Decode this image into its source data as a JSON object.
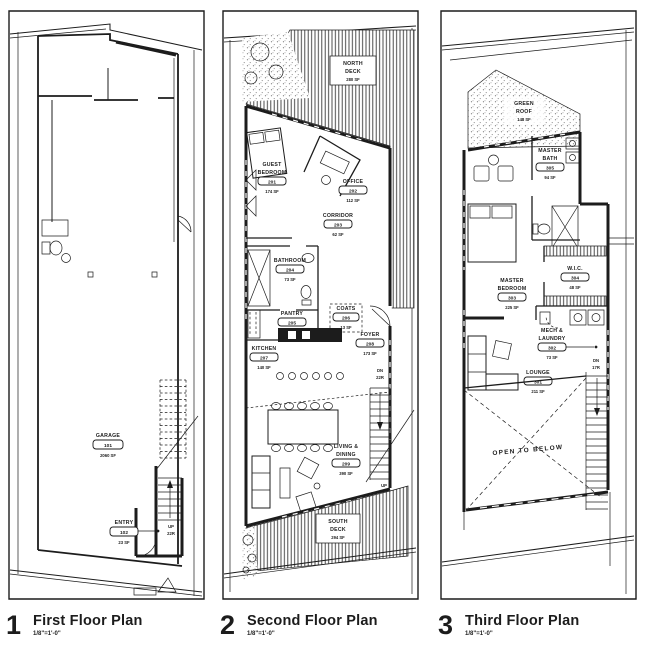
{
  "sheet": {
    "paper": "#ffffff",
    "ink": "#1c1c1c"
  },
  "plans": [
    {
      "caption_number": "1",
      "caption_title": "First Floor Plan",
      "caption_scale": "1/8\"=1'-0\"",
      "rooms": [
        {
          "name": "GARAGE",
          "lines": [
            "GARAGE"
          ],
          "number": "101",
          "area": "2060 SF"
        },
        {
          "name": "ENTRY",
          "lines": [
            "ENTRY"
          ],
          "number": "102",
          "area": "23 SF"
        }
      ],
      "stairs": [
        {
          "direction": "UP",
          "risers": "22R"
        }
      ]
    },
    {
      "caption_number": "2",
      "caption_title": "Second Floor Plan",
      "caption_scale": "1/8\"=1'-0\"",
      "decks": [
        {
          "lines": [
            "NORTH",
            "DECK"
          ],
          "area": "280 SF"
        },
        {
          "lines": [
            "SOUTH",
            "DECK"
          ],
          "area": "294 SF"
        }
      ],
      "rooms": [
        {
          "lines": [
            "GUEST",
            "BEDROOM"
          ],
          "number": "201",
          "area": "174 SF"
        },
        {
          "lines": [
            "OFFICE"
          ],
          "number": "202",
          "area": "112 SF"
        },
        {
          "lines": [
            "CORRIDOR"
          ],
          "number": "203",
          "area": "62 SF"
        },
        {
          "lines": [
            "BATHROOM"
          ],
          "number": "204",
          "area": "73 SF"
        },
        {
          "lines": [
            "PANTRY"
          ],
          "number": "205",
          "area": "23 SF"
        },
        {
          "lines": [
            "COATS"
          ],
          "number": "206",
          "area": "13 SF"
        },
        {
          "lines": [
            "KITCHEN"
          ],
          "number": "207",
          "area": "140 SF"
        },
        {
          "lines": [
            "FOYER"
          ],
          "number": "208",
          "area": "173 SF"
        },
        {
          "lines": [
            "LIVING &",
            "DINING"
          ],
          "number": "209",
          "area": "390 SF"
        }
      ],
      "stairs": [
        {
          "direction": "DN",
          "risers": "22R"
        },
        {
          "direction": "UP",
          "risers": "17R"
        }
      ]
    },
    {
      "caption_number": "3",
      "caption_title": "Third Floor Plan",
      "caption_scale": "1/8\"=1'-0\"",
      "roof": {
        "lines": [
          "GREEN",
          "ROOF"
        ],
        "area": "148 SF"
      },
      "rooms": [
        {
          "lines": [
            "LOUNGE"
          ],
          "number": "301",
          "area": "211 SF"
        },
        {
          "lines": [
            "MECH &",
            "LAUNDRY"
          ],
          "number": "302",
          "area": "73 SF"
        },
        {
          "lines": [
            "MASTER",
            "BEDROOM"
          ],
          "number": "303",
          "area": "225 SF"
        },
        {
          "lines": [
            "W.I.C."
          ],
          "number": "304",
          "area": "48 SF"
        },
        {
          "lines": [
            "MASTER",
            "BATH"
          ],
          "number": "305",
          "area": "94 SF"
        }
      ],
      "annotations": {
        "open_to_below": "OPEN TO BELOW"
      },
      "stairs": [
        {
          "direction": "DN",
          "risers": "17R"
        }
      ]
    }
  ]
}
